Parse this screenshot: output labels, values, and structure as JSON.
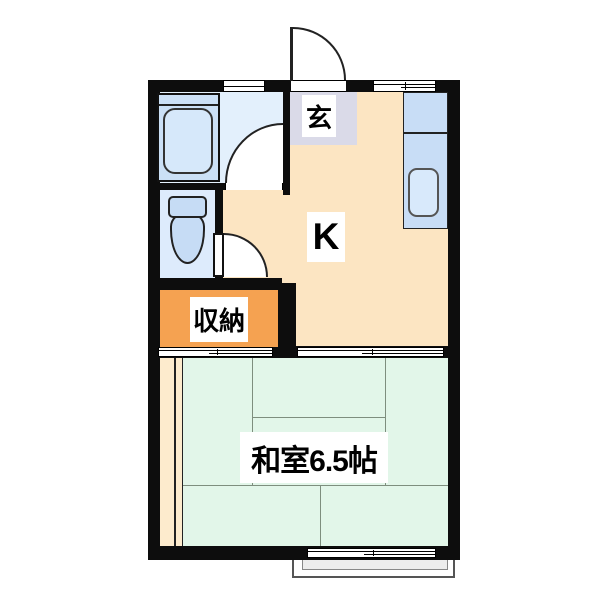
{
  "labels": {
    "entrance": "玄",
    "kitchen": "K",
    "storage": "収納",
    "japanese_room": "和室6.5帖"
  },
  "colors": {
    "wall": "#0d0d0d",
    "kitchen_floor": "#fce5c2",
    "entrance_floor": "#dadae8",
    "bathroom_floor": "#e3f0fc",
    "toilet_floor": "#ddebfc",
    "fixture_blue": "#c8ddf6",
    "storage_orange": "#f5a251",
    "tatami_green": "#e2f6e9",
    "edge_strip_cream": "#fdebcd",
    "balcony_gray": "#ededed"
  }
}
